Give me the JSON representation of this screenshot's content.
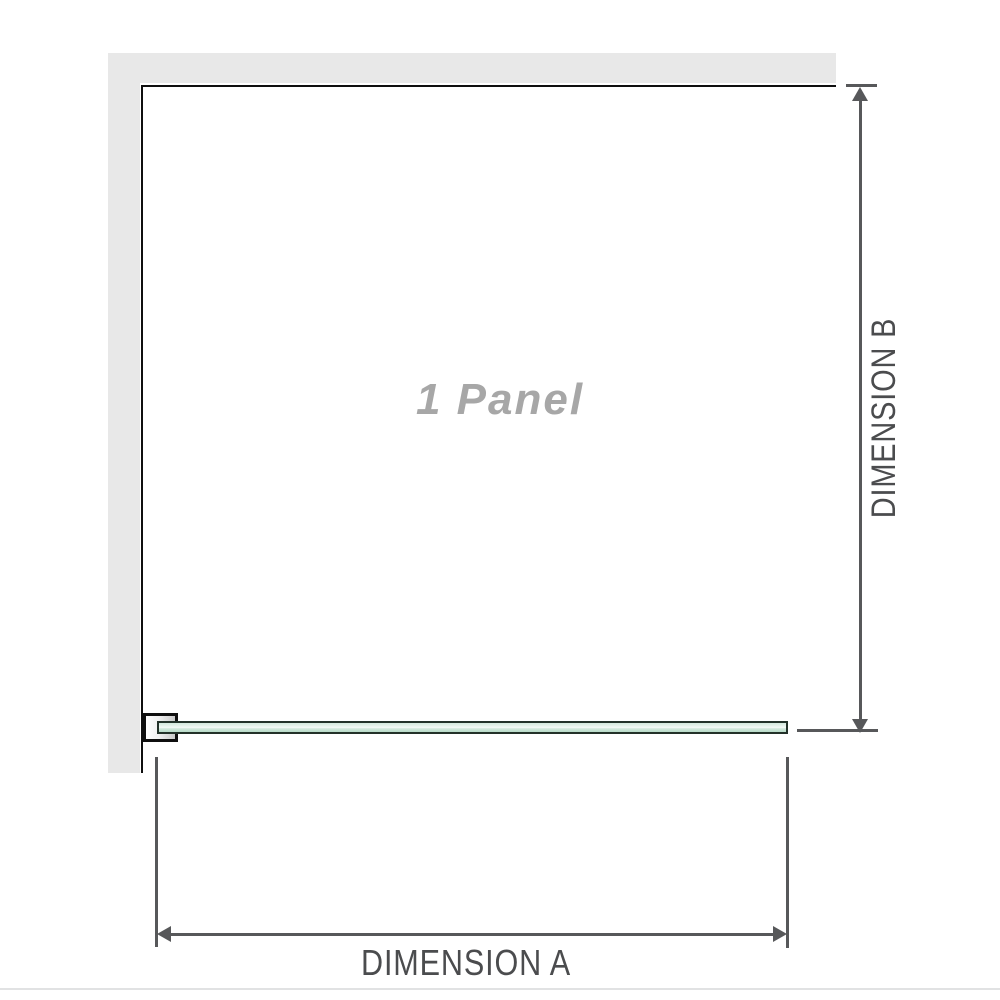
{
  "diagram": {
    "panel_label": "1 Panel",
    "dimensions": {
      "a": {
        "label": "DIMENSION A",
        "orientation": "horizontal"
      },
      "b": {
        "label": "DIMENSION B",
        "orientation": "vertical"
      }
    }
  },
  "colors": {
    "background": "#ffffff",
    "wall": "#e8e8e8",
    "outline": "#0f0f0f",
    "dim": "#57585a",
    "dim-text": "#4b4c4e",
    "panel-text": "#a7a7a7",
    "glass-border": "#233129",
    "glass-light": "#eaf4ee",
    "glass-mid": "#d3e8dc",
    "glass-deep": "#b7dbc8",
    "bracket-fill-start": "#ffffff",
    "bracket-fill-end": "#c9c9c9",
    "separator": "#e1e2e3"
  }
}
